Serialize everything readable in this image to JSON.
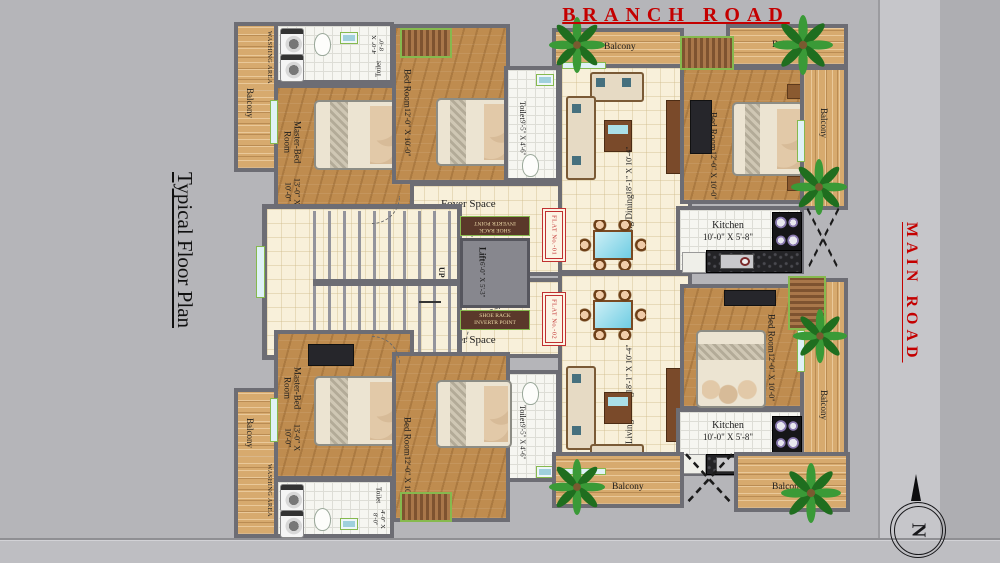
{
  "colors": {
    "road_text_red": "#c40000",
    "wall_gray": "#6d6d74",
    "wood_floor": "#bf8c4f",
    "balcony_wood": "#d7aa6e",
    "foyer_cream": "#f8f0da",
    "background_gray": "#b5b5b9",
    "accent_green": "#86b94e"
  },
  "roads": {
    "branch": "BRANCH ROAD",
    "main": "MAIN ROAD"
  },
  "plan_title": "Typical Floor Plan",
  "compass": {
    "north": "N"
  },
  "labels": {
    "balcony": "Balcony",
    "washing_area": "WASHING AREA",
    "foyer": "Foyer Space",
    "up": "UP"
  },
  "core": {
    "lift_name": "Lift",
    "lift_size": "6'-0\" X 5'-3\"",
    "shoe_rack_line1": "SHOE RACK",
    "shoe_rack_line2": "INVERTR POINT",
    "flat1": "FLAT No.-01",
    "flat2": "FLAT No.-02"
  },
  "rooms": {
    "master_bed": {
      "name": "Master-Bed Room",
      "size": "13'-0\" X 10'-0\""
    },
    "bed": {
      "name": "Bed Room",
      "size": "12'-0\" X 10'-0\""
    },
    "toilet_small": {
      "name": "Toilet",
      "size": "4'-0\" X 8'-0\""
    },
    "toilet_long": {
      "name": "Toilet",
      "size": "9'-5\" X 4'-6\""
    },
    "kitchen": {
      "name": "Kitchen",
      "size": "10'-0\" X 5'-8\""
    },
    "living_dining": {
      "name": "Living/Dining",
      "size": "18'-1\" X 10'-4\""
    }
  }
}
